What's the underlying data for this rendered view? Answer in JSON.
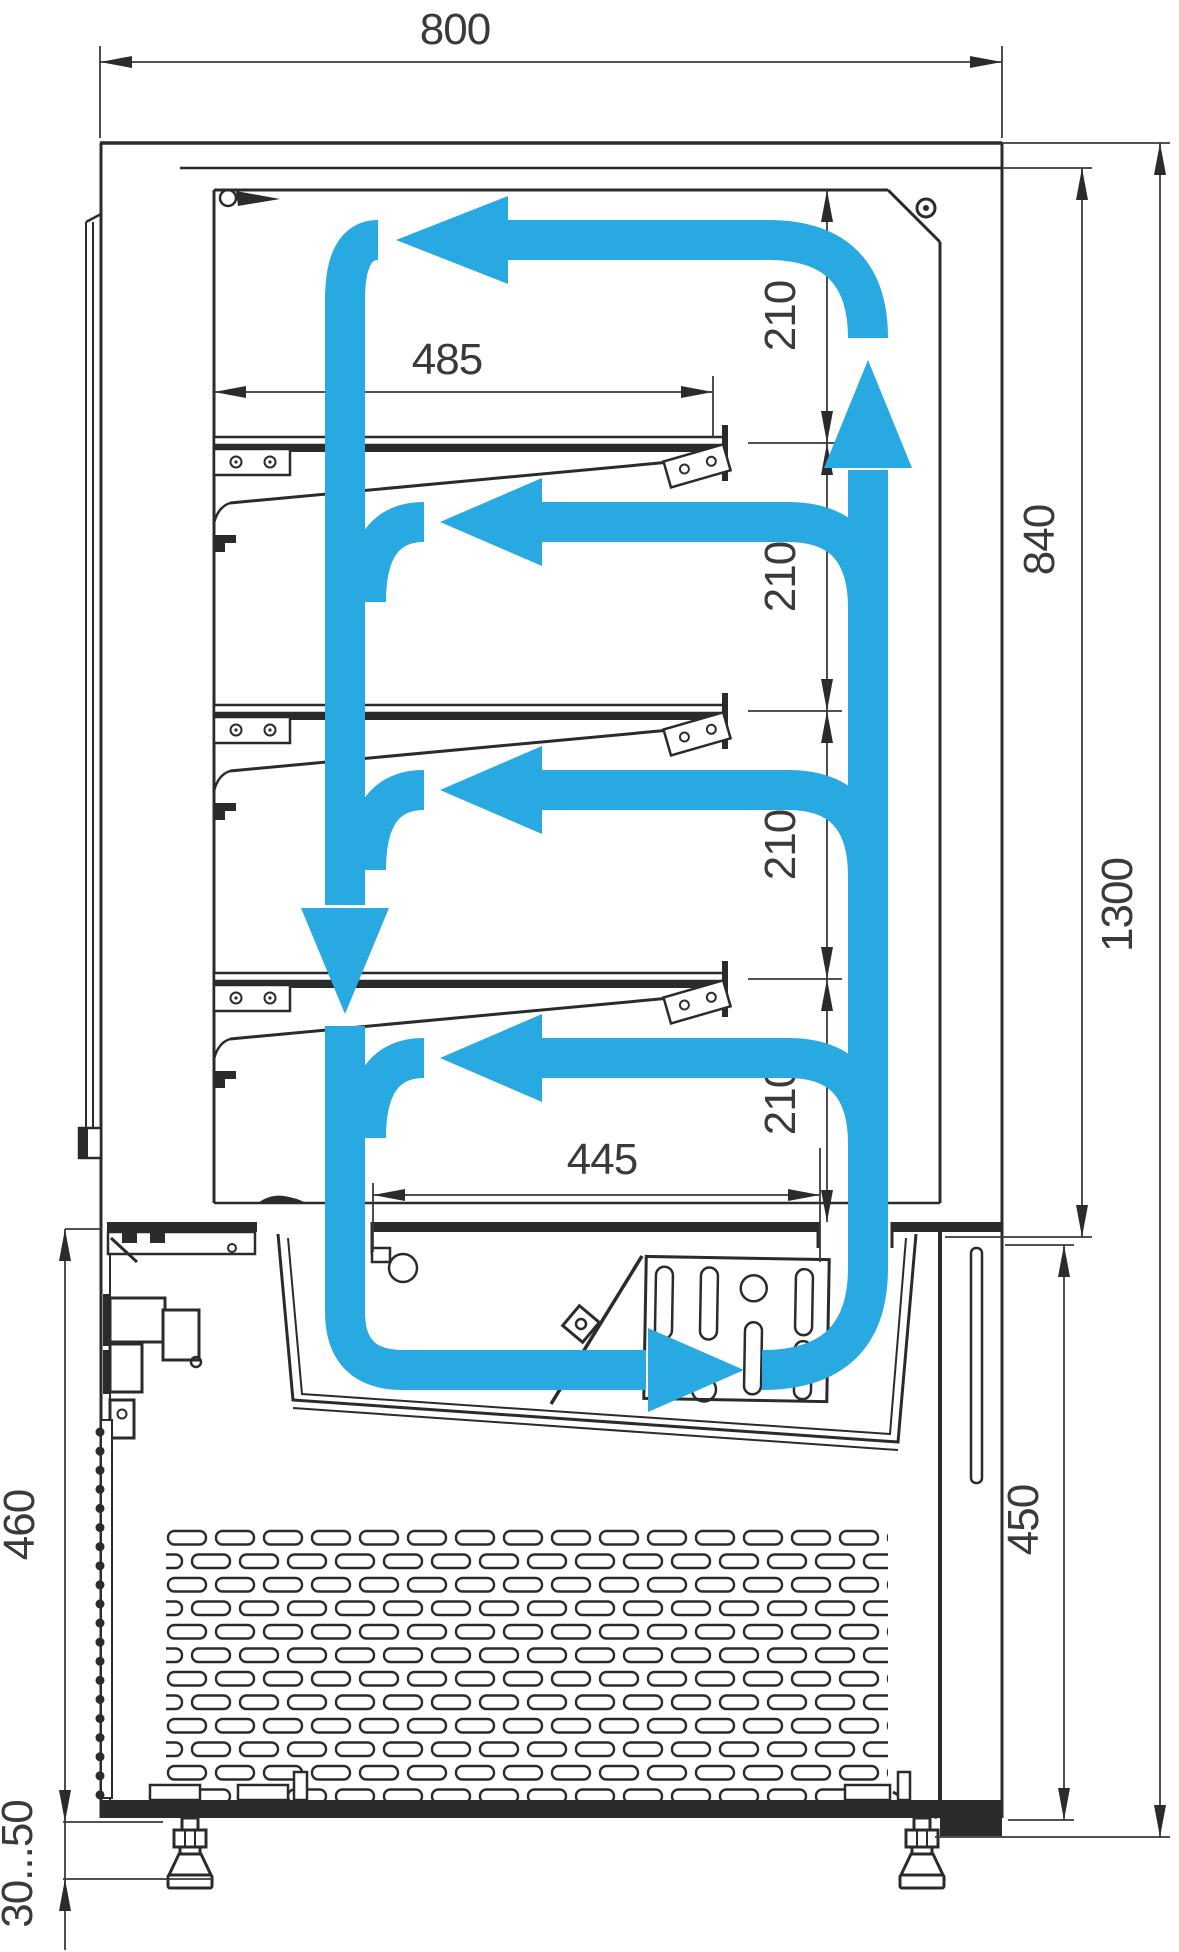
{
  "diagram": {
    "type": "technical-drawing",
    "subject": "refrigerated pastry display case - side section with air circulation loop",
    "units": "mm",
    "colors": {
      "airflow": "#29A9E1",
      "linework": "#2b2b2b",
      "background": "#ffffff"
    },
    "dimensions": {
      "overall_width": {
        "value": "800"
      },
      "overall_height": {
        "value": "1300"
      },
      "display_chamber_height": {
        "value": "840"
      },
      "base_section_height": {
        "value": "450"
      },
      "base_inner_height": {
        "value": "460"
      },
      "shelf_depth": {
        "value": "485"
      },
      "base_duct_span": {
        "value": "445"
      },
      "foot_adjustment": {
        "value": "30...50"
      },
      "shelf_spacing": [
        "210",
        "210",
        "210",
        "210"
      ]
    },
    "airflow": {
      "color": "#29A9E1",
      "pattern": "closed loop: up the rear duct, across the top, down the front glass, branch under each of 3 shelves, return through base duct to evaporator"
    }
  }
}
